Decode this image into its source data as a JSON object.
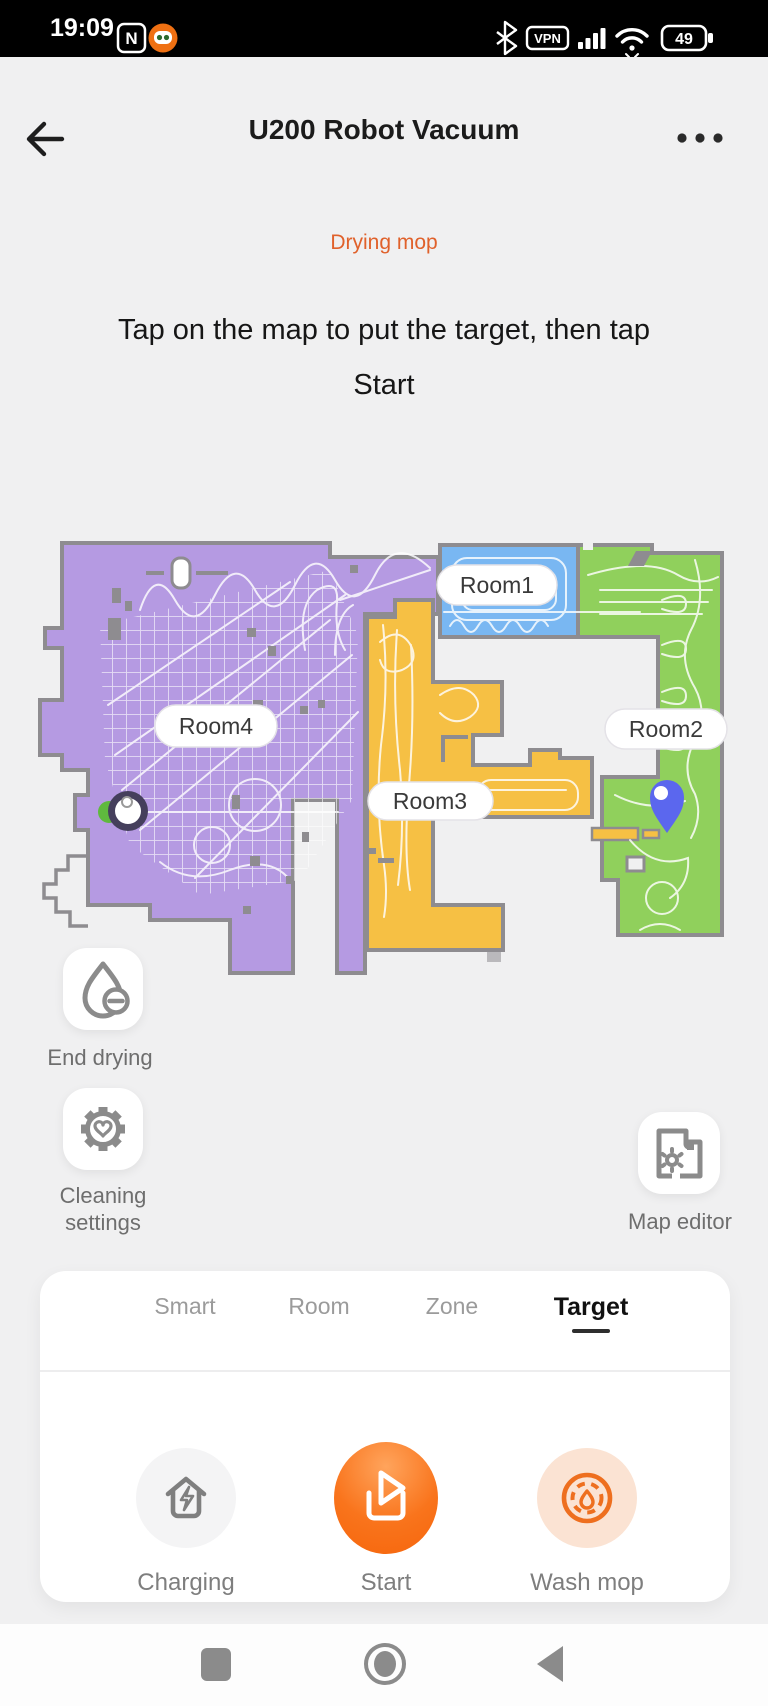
{
  "status_bar": {
    "time": "19:09",
    "nfc_label": "N",
    "vpn_label": "VPN",
    "battery_percent": "49",
    "icons": [
      "nfc-icon",
      "app-icon",
      "bluetooth-icon",
      "vpn-badge",
      "signal-icon",
      "wifi-icon",
      "battery-icon"
    ]
  },
  "header": {
    "title": "U200 Robot Vacuum"
  },
  "status": {
    "label": "Drying mop",
    "color": "#e0612b"
  },
  "instruction": {
    "line1": "Tap on the map to put the target, then tap",
    "line2": "Start"
  },
  "map": {
    "rooms": [
      {
        "id": "room1",
        "label": "Room1",
        "color": "#79b7f2"
      },
      {
        "id": "room2",
        "label": "Room2",
        "color": "#90d05c"
      },
      {
        "id": "room3",
        "label": "Room3",
        "color": "#f6c044"
      },
      {
        "id": "room4",
        "label": "Room4",
        "color": "#b59ae2"
      }
    ],
    "wall_color": "#8e8c90",
    "background_color": "#f0f0f1",
    "target_pin_color": "#5b67ee",
    "dock": "charging-dock"
  },
  "side_actions": {
    "end_drying": "End drying",
    "cleaning_settings_line1": "Cleaning",
    "cleaning_settings_line2": "settings",
    "map_editor": "Map editor"
  },
  "mode_tabs": {
    "active": "Target",
    "items": [
      {
        "label": "Smart"
      },
      {
        "label": "Room"
      },
      {
        "label": "Zone"
      },
      {
        "label": "Target"
      }
    ]
  },
  "actions": {
    "charging": "Charging",
    "start": "Start",
    "wash_mop": "Wash mop",
    "start_color": "#f86c12"
  }
}
